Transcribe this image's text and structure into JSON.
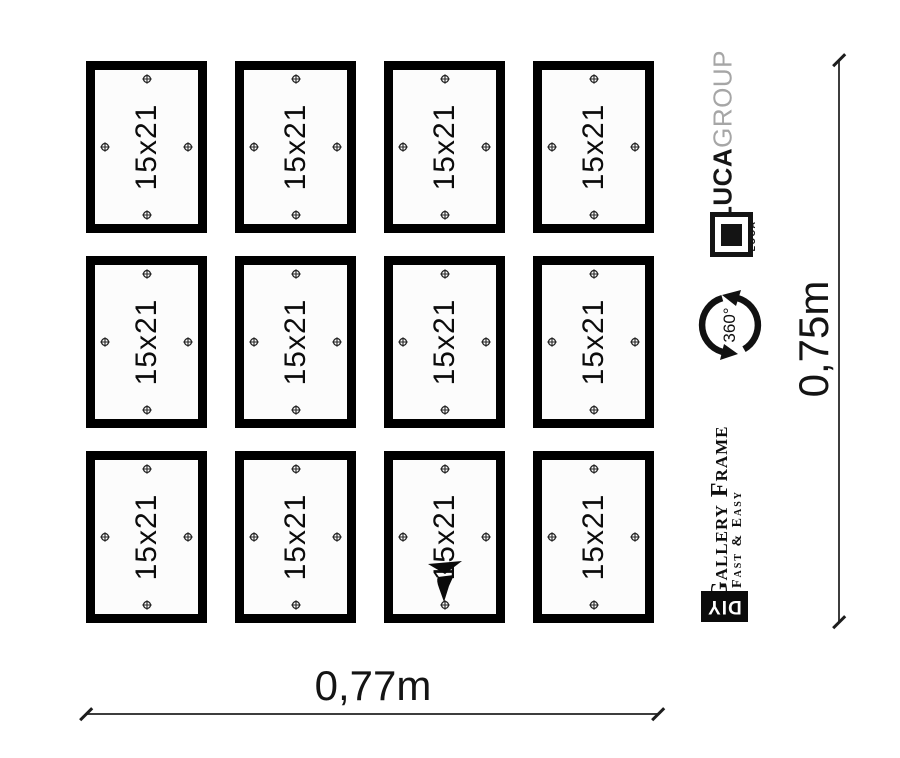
{
  "frame": {
    "label": "15x21",
    "rows": 3,
    "cols": 4,
    "count": 12
  },
  "branding": {
    "luca": "LUCA",
    "group": "GROUP",
    "logo_text": "LUCA",
    "rotation_badge": "360°",
    "product_line1": "Gallery Frame",
    "product_line2": "Fast & Easy",
    "diy": "DIY"
  },
  "dimensions": {
    "width_label": "0,77m",
    "height_label": "0,75m"
  },
  "colors": {
    "frame_black": "#000000",
    "group_gray": "#a6a6a6",
    "ink": "#141414"
  }
}
